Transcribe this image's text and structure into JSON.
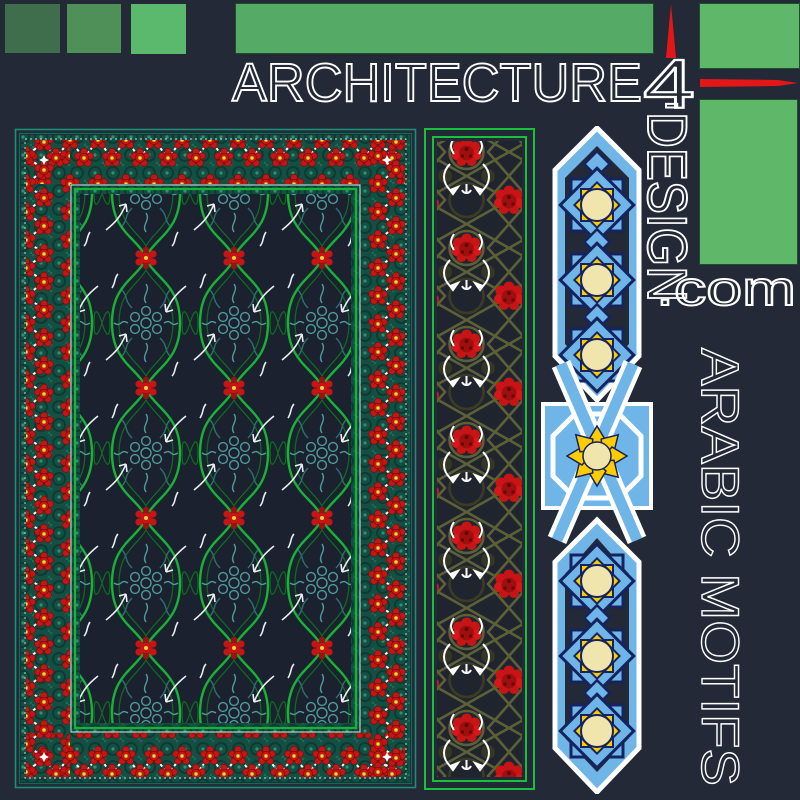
{
  "branding": {
    "architecture": "ARCHITECTURE",
    "numeral": "4",
    "hyphen": "-",
    "design": "DESIGN",
    "domain_suffix": ".com"
  },
  "side_title": "ARABIC MOTIFS",
  "icons": {
    "up_arrow": "red-up-arrow",
    "right_arrow": "red-right-arrow"
  },
  "colors": {
    "background": "#232936",
    "swatch_dark_green": "#3e6e4b",
    "swatch_mid_green": "#4e9058",
    "swatch_bright_green": "#5bb96d",
    "brand_bar_green": "#55ab66",
    "side_rect_green": "#5fb86a",
    "arrow_red": "#e31717",
    "outline_text_white": "#ffffff",
    "carpet_field_navy": "#1b212e",
    "carpet_border_teal": "#135043",
    "lattice_green": "#17b335",
    "flower_red": "#c81414",
    "flower_yellow_center": "#f0d83c",
    "floral_teal": "#4f9a9a",
    "strip_olive": "#5c6036",
    "panel_light_blue": "#6fb5e8",
    "panel_navy_outline": "#15235f",
    "star_yellow": "#ffcc00",
    "star_cream": "#f0e5ad"
  }
}
